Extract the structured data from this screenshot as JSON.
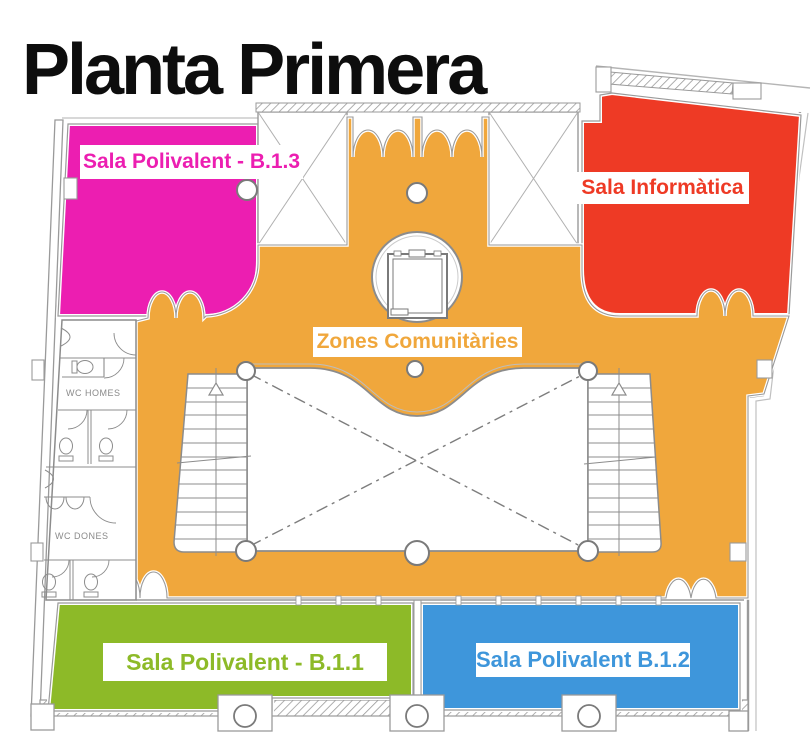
{
  "title": "Planta Primera",
  "floor_plan": {
    "zones": [
      {
        "id": "sala-polivalent-b13",
        "label": "Sala Polivalent - B.1.3",
        "color": "#ec1eb1"
      },
      {
        "id": "sala-informatica",
        "label": "Sala Informàtica",
        "color": "#ee3a25"
      },
      {
        "id": "zones-comunitaries",
        "label": "Zones Comunitàries",
        "color": "#f0a73c"
      },
      {
        "id": "sala-polivalent-b11",
        "label": "Sala Polivalent - B.1.1",
        "color": "#8dba28"
      },
      {
        "id": "sala-polivalent-b12",
        "label": "Sala Polivalent B.1.2",
        "color": "#3e96db"
      }
    ],
    "rooms": [
      {
        "id": "wc-homes",
        "label": "WC HOMES"
      },
      {
        "id": "wc-dones",
        "label": "WC DONES"
      }
    ],
    "wall_color": "#8a8a8a"
  }
}
